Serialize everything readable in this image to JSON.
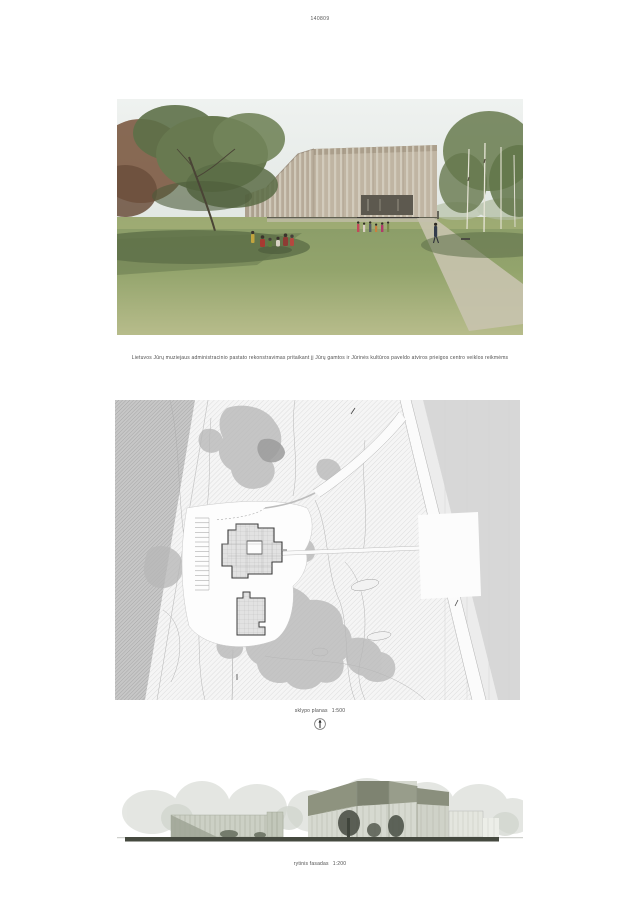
{
  "board": {
    "entry_code": "140809",
    "project_title": "Lietuvos Jūrų muziejaus administracinio pastato rekonstravimas pritaikant jį Jūrų gamtos ir Jūrinės kultūros paveldo atviros prieigos centro veiklos reikmėms",
    "siteplan": {
      "label": "sklypo planas",
      "scale": "1:500"
    },
    "elevation": {
      "label": "rytinis fasadas",
      "scale": "1:200"
    }
  },
  "colors": {
    "page_bg": "#ffffff",
    "caption_text": "#4e4e4e",
    "facade_beige": "#c0b5a3",
    "facade_stripe": "#d9d3c5",
    "grass_green": "#93a46c",
    "grass_shadow": "#5a6b46",
    "foliage_green": "#687950",
    "foliage_red": "#7c5a42",
    "plan_hatch": "#cdcdcd",
    "plan_forest": "#c2c2c2",
    "plan_canopy": "#b8b8b8",
    "plan_building_outline": "#3c3c3c",
    "elevation_olive": "#8e937f",
    "elevation_ground": "#45493f"
  }
}
